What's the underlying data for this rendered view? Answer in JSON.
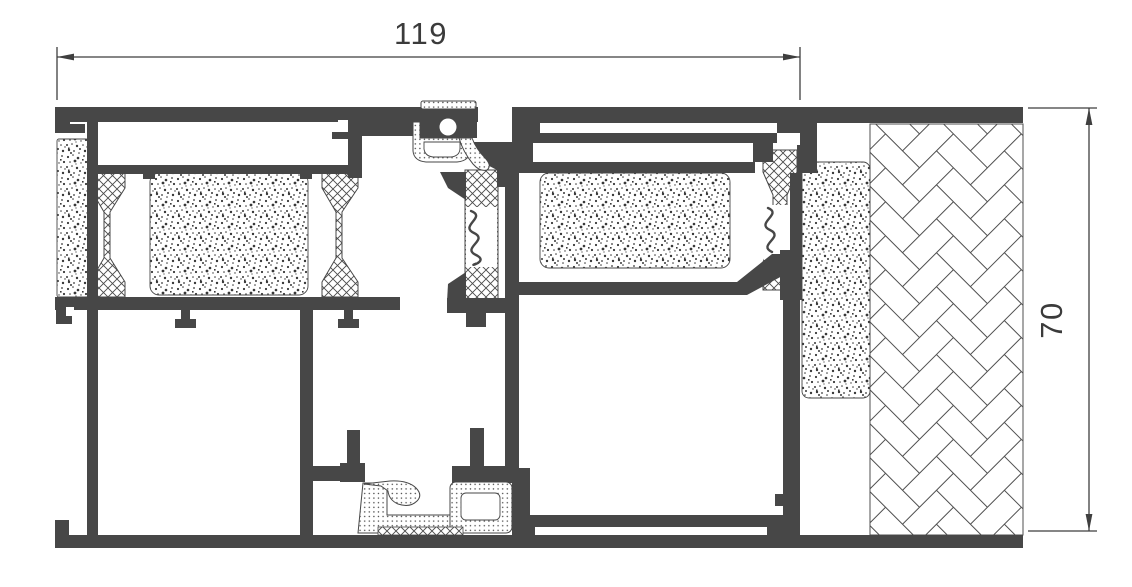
{
  "drawing": {
    "type": "technical-cross-section",
    "dimensions": {
      "width": {
        "label": "119"
      },
      "height": {
        "label": "70"
      }
    },
    "colors": {
      "profile": "#474747",
      "dimension_lines": "#3f3f3f",
      "background": "#ffffff"
    },
    "materials": [
      {
        "name": "aluminium-profile",
        "fill": "solid-dark"
      },
      {
        "name": "thermal-break",
        "fill": "crosshatch"
      },
      {
        "name": "foam-insulation",
        "fill": "stipple"
      },
      {
        "name": "rubber-gasket",
        "fill": "fine-dots"
      },
      {
        "name": "masonry-wall",
        "fill": "herringbone"
      }
    ]
  }
}
